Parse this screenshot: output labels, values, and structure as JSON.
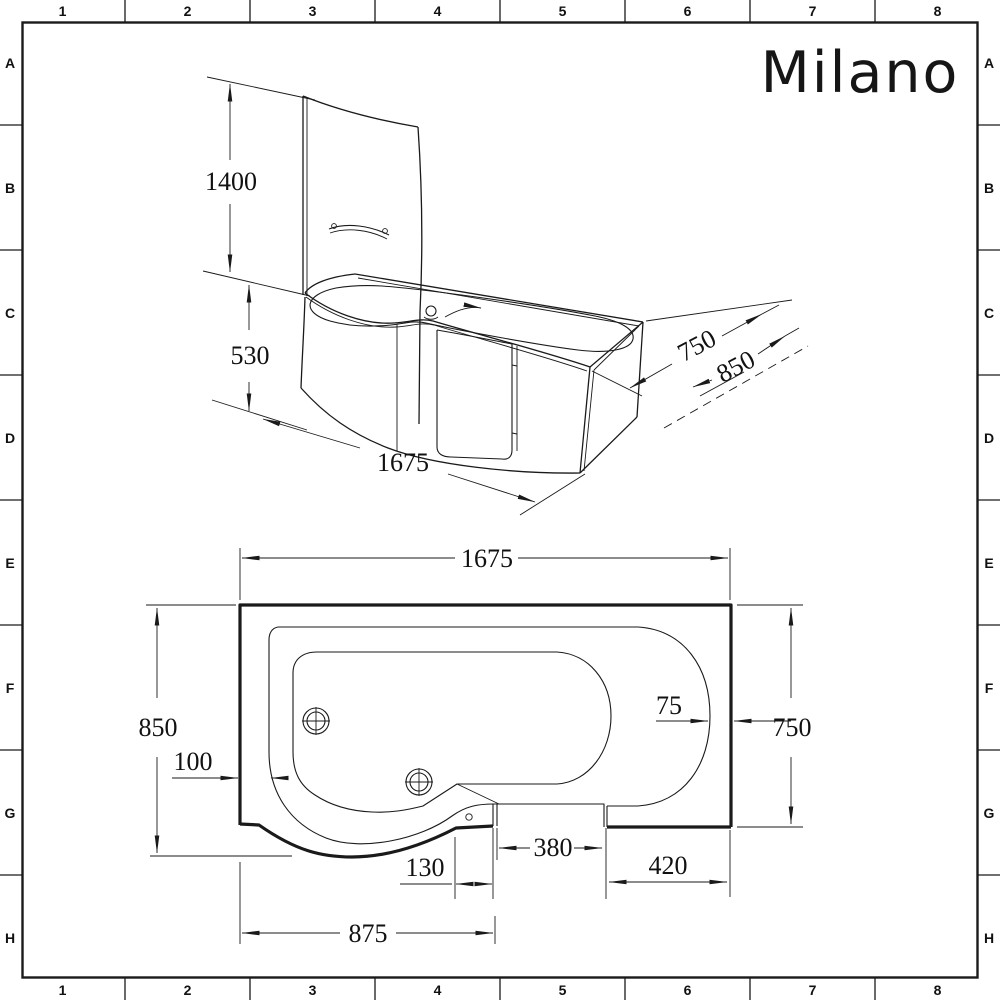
{
  "frame": {
    "columns": [
      "1",
      "2",
      "3",
      "4",
      "5",
      "6",
      "7",
      "8"
    ],
    "rows": [
      "A",
      "B",
      "C",
      "D",
      "E",
      "F",
      "G",
      "H"
    ]
  },
  "logo": {
    "brand": "Milano"
  },
  "drawing": {
    "type": "technical-drawing",
    "subject": "P-shaped shower bath with glass screen and access door",
    "colors": {
      "line": "#1a1a1a",
      "background": "#ffffff"
    },
    "views": {
      "isometric": {
        "dimensions": {
          "screen_height": "1400",
          "bath_height": "530",
          "length": "1675",
          "rim_width": "750",
          "overall_width": "850"
        }
      },
      "plan": {
        "dimensions": {
          "length": "1675",
          "overall_width": "850",
          "end_width": "750",
          "rim_edge_gap": "75",
          "rim_inset": "100",
          "seat_width": "130",
          "door_opening": "380",
          "end_panel": "420",
          "shower_section": "875"
        }
      }
    }
  }
}
